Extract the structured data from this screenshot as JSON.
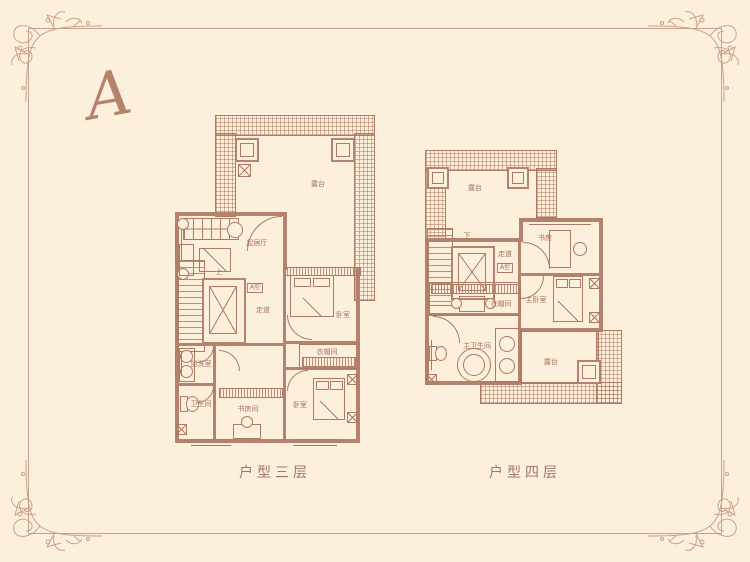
{
  "monogram": "A",
  "colors": {
    "background": "#fcefdc",
    "plan_line": "#ad7a64",
    "wall_fill": "#b5826e",
    "frame_border": "#c8a28c",
    "label_text": "#a4745f"
  },
  "plan3": {
    "caption": "户型三层",
    "rooms": {
      "terrace": "露台",
      "living": "起居厅",
      "stairs_up": "上",
      "corridor": "走道",
      "unit_badge": "A型",
      "bedroom": "卧室",
      "closet": "衣帽间",
      "washroom": "盥洗室",
      "bathroom": "卫生间",
      "study": "书房间",
      "bedroom2": "卧室"
    }
  },
  "plan4": {
    "caption": "户型四层",
    "rooms": {
      "terrace": "露台",
      "stairs_down": "下",
      "corridor": "走道",
      "unit_badge": "A型",
      "study": "书房",
      "closet": "衣帽间",
      "master_bedroom": "主卧室",
      "master_bathroom": "主卫生间",
      "terrace2": "露台"
    }
  }
}
